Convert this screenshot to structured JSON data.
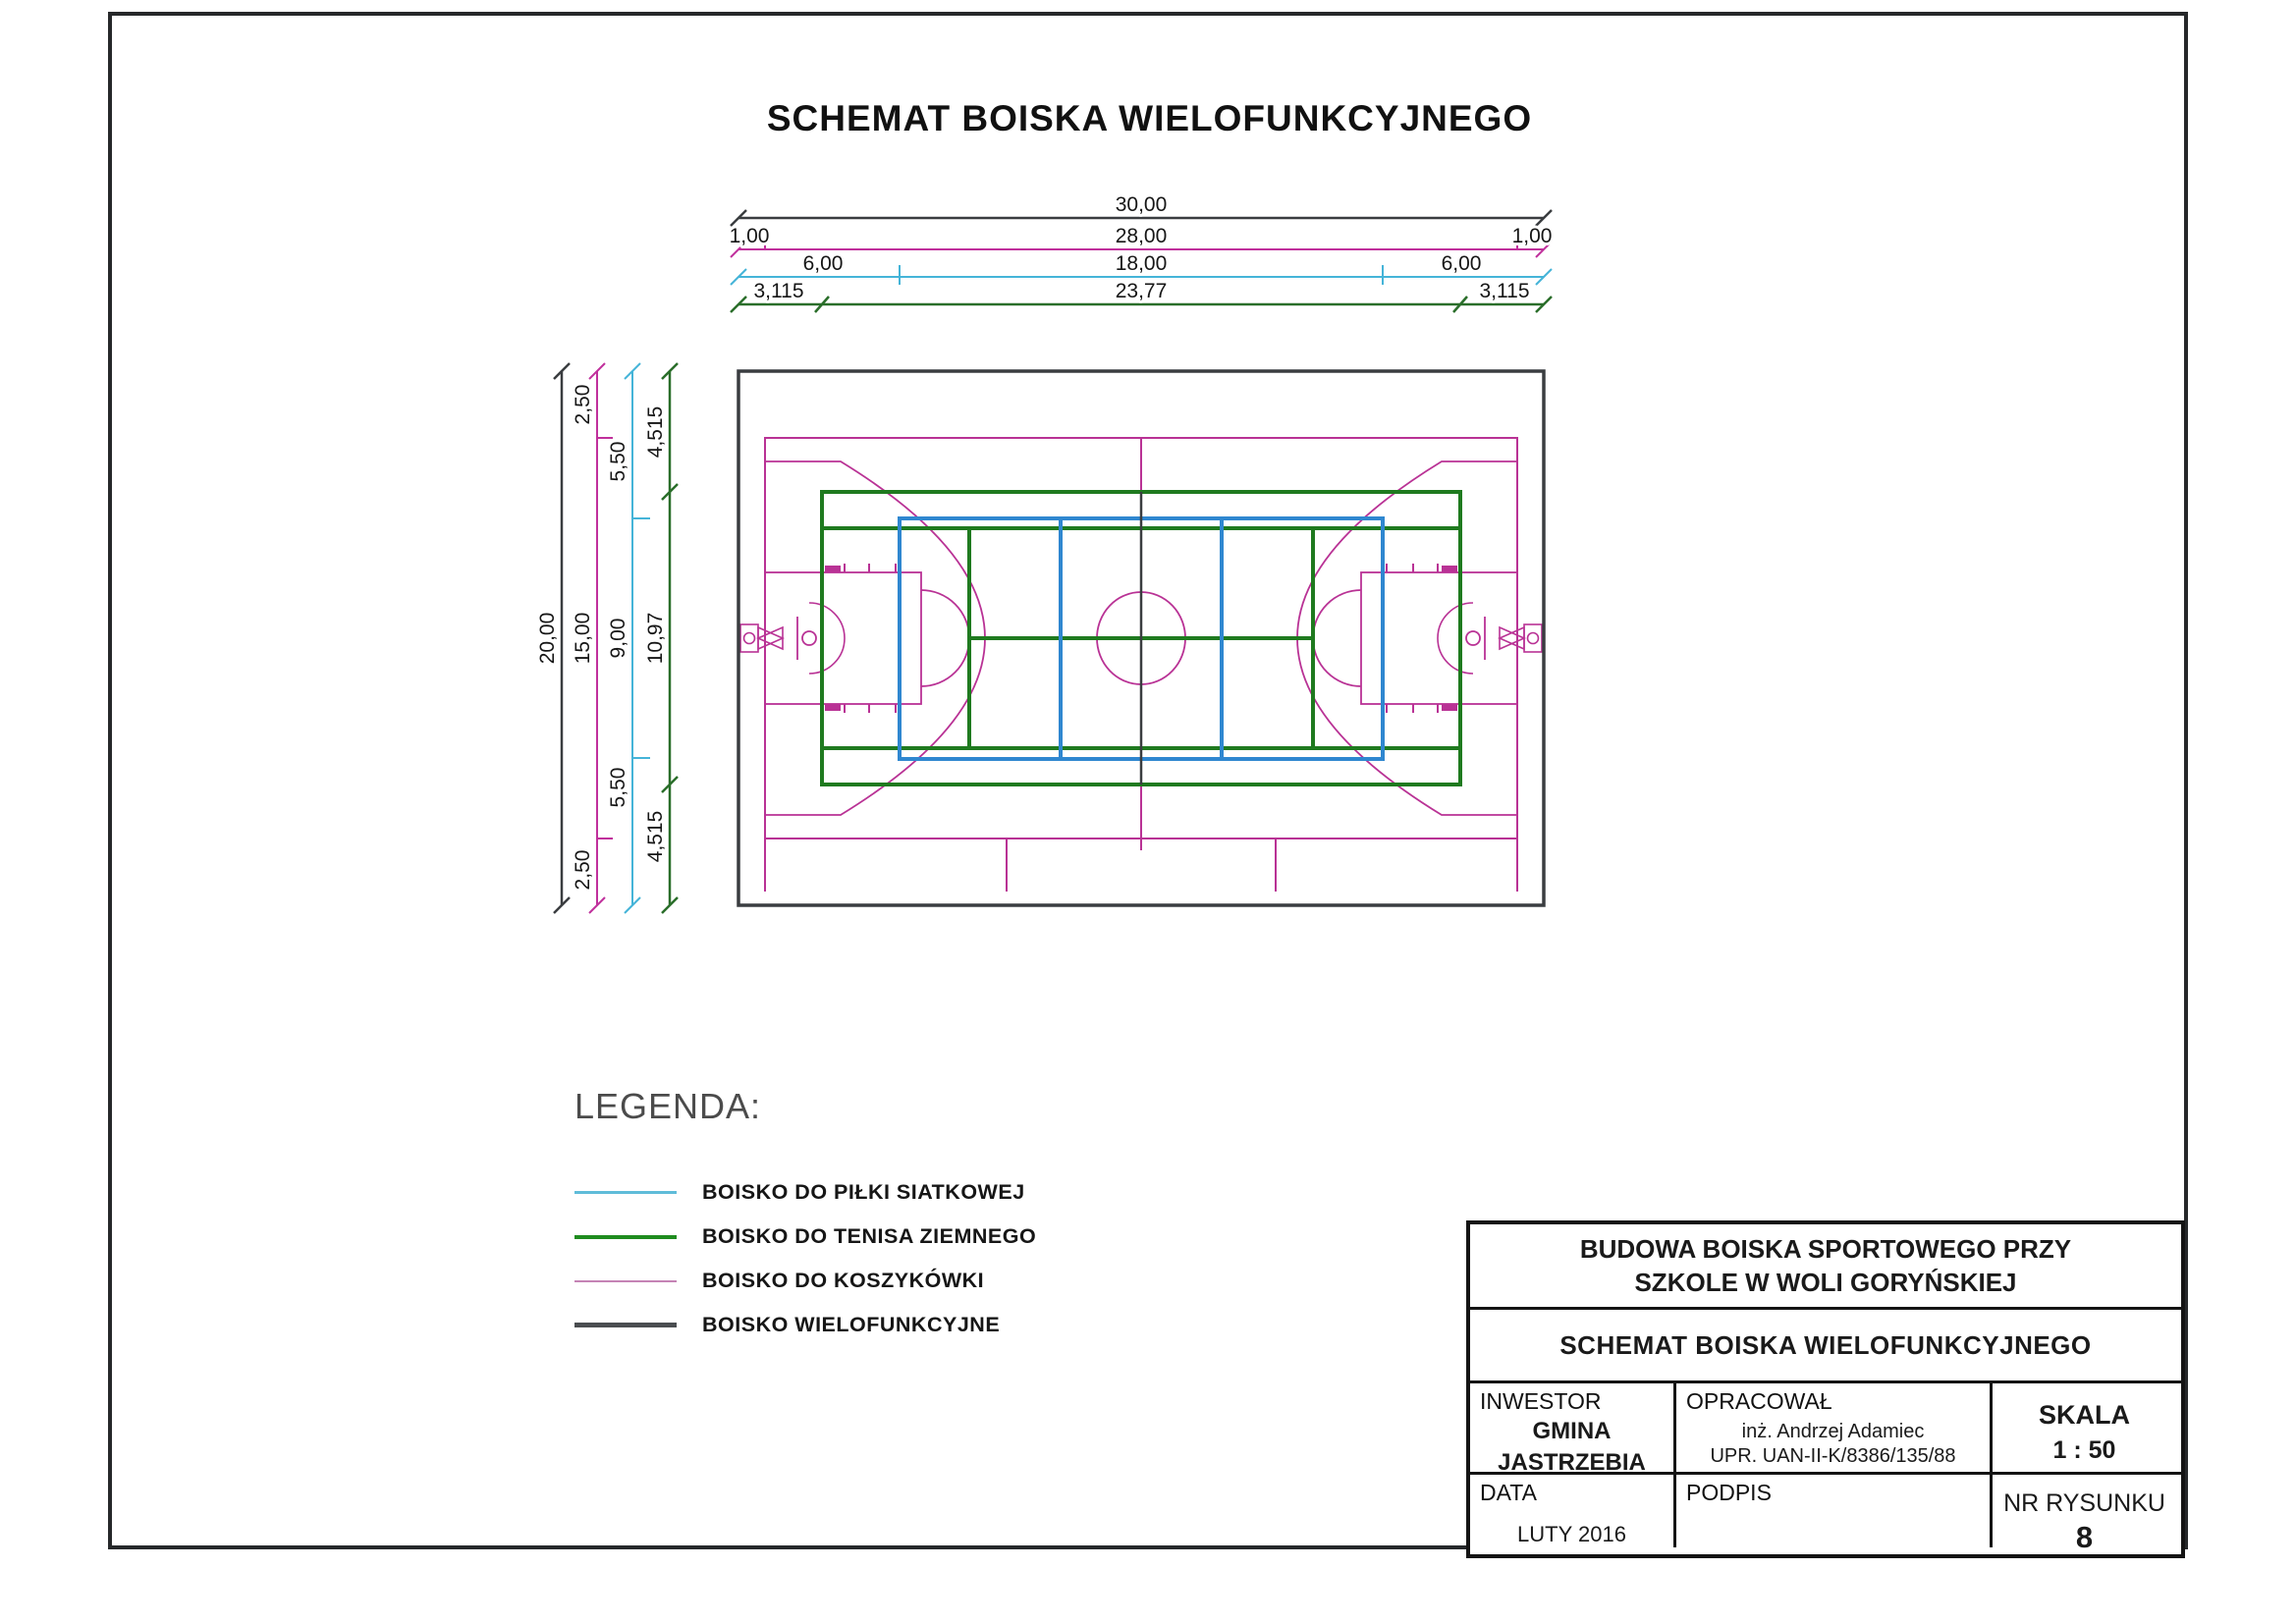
{
  "page": {
    "title": "SCHEMAT BOISKA WIELOFUNKCYJNEGO"
  },
  "colors": {
    "dark": "#3a3d40",
    "magenta": "#b93295",
    "magenta_dim": "#c0309c",
    "cyan": "#45b4d8",
    "green": "#1f7a1f",
    "green_dim": "#2a6e2a",
    "blue": "#2f87d0",
    "text": "#161616"
  },
  "dimensions": {
    "top": [
      {
        "name": "field-width",
        "segments": [
          "30,00"
        ]
      },
      {
        "name": "basketball-width",
        "segments": [
          "1,00",
          "28,00",
          "1,00"
        ]
      },
      {
        "name": "volleyball-width",
        "segments": [
          "6,00",
          "18,00",
          "6,00"
        ]
      },
      {
        "name": "tennis-width",
        "segments": [
          "3,115",
          "23,77",
          "3,115"
        ]
      }
    ],
    "left": [
      {
        "name": "field-height",
        "segments": [
          "20,00"
        ]
      },
      {
        "name": "basketball-height",
        "segments": [
          "2,50",
          "15,00",
          "2,50"
        ]
      },
      {
        "name": "volleyball-height",
        "segments": [
          "5,50",
          "9,00",
          "5,50"
        ]
      },
      {
        "name": "tennis-height",
        "segments": [
          "4,515",
          "10,97",
          "4,515"
        ]
      }
    ]
  },
  "legend": {
    "heading": "LEGENDA:",
    "items": [
      {
        "label": "BOISKO DO PIŁKI SIATKOWEJ",
        "color": "#5fbcd9"
      },
      {
        "label": "BOISKO DO TENISA ZIEMNEGO",
        "color": "#1f8c1f"
      },
      {
        "label": "BOISKO DO KOSZYKÓWKI",
        "color": "#c583b5"
      },
      {
        "label": "BOISKO WIELOFUNKCYJNE",
        "color": "#4a4d50"
      }
    ]
  },
  "title_block": {
    "project_line1": "BUDOWA BOISKA SPORTOWEGO PRZY",
    "project_line2": "SZKOLE W WOLI GORYŃSKIEJ",
    "drawing_title": "SCHEMAT BOISKA WIELOFUNKCYJNEGO",
    "investor_label": "INWESTOR",
    "investor_line1": "GMINA",
    "investor_line2": "JASTRZEBIA",
    "author_label": "OPRACOWAŁ",
    "author_name": "inż. Andrzej Adamiec",
    "author_license": "UPR. UAN-II-K/8386/135/88",
    "scale_label": "SKALA",
    "scale_value": "1 : 50",
    "date_label": "DATA",
    "date_value": "LUTY 2016",
    "signature_label": "PODPIS",
    "drawing_number_label": "NR RYSUNKU",
    "drawing_number_value": "8"
  }
}
